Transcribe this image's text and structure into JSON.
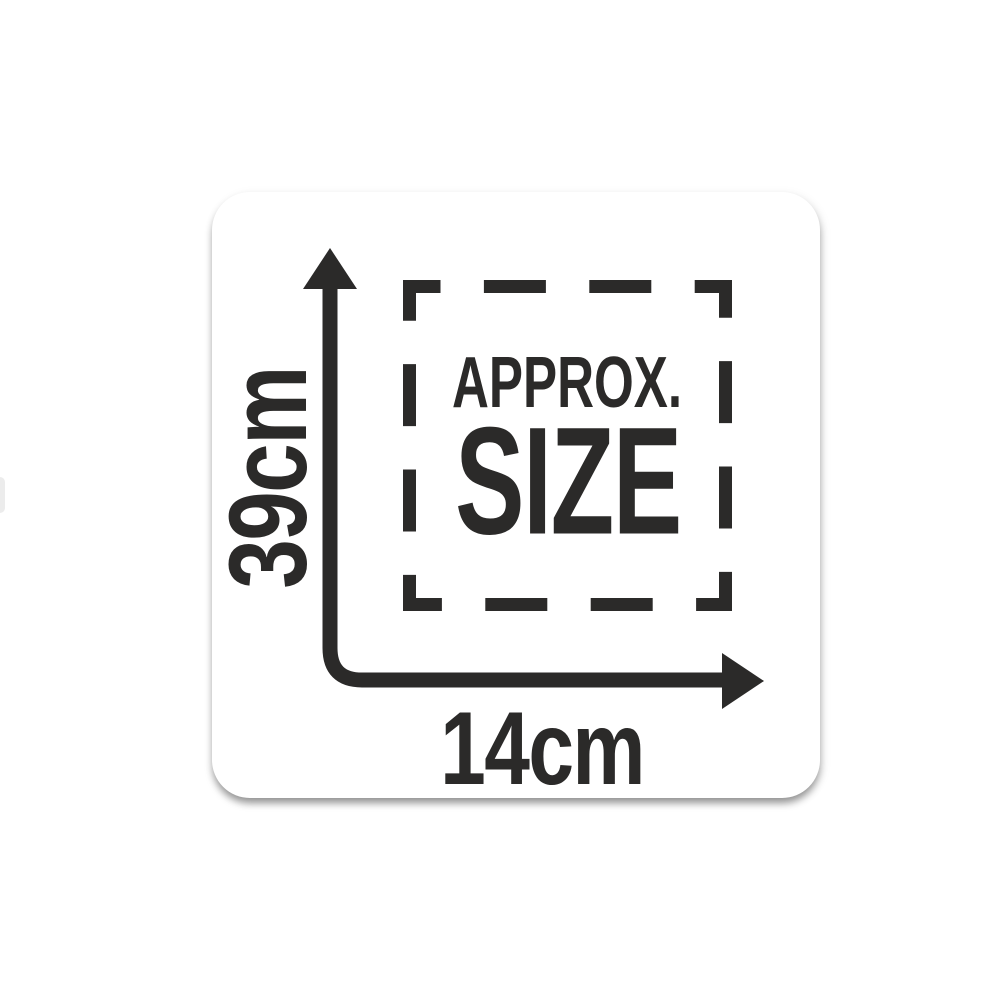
{
  "page": {
    "background": "#ffffff"
  },
  "badge": {
    "approx_label": "APPROX.",
    "size_label": "SIZE",
    "height_label": "39cm",
    "width_label": "14cm"
  },
  "colors": {
    "ink": "#2b2a29",
    "card_background": "#ffffff"
  },
  "icons": {
    "dashed_outline_box": "dashed-outline-box",
    "up_arrowhead": "up-arrowhead-icon",
    "right_arrowhead": "right-arrowhead-icon"
  }
}
